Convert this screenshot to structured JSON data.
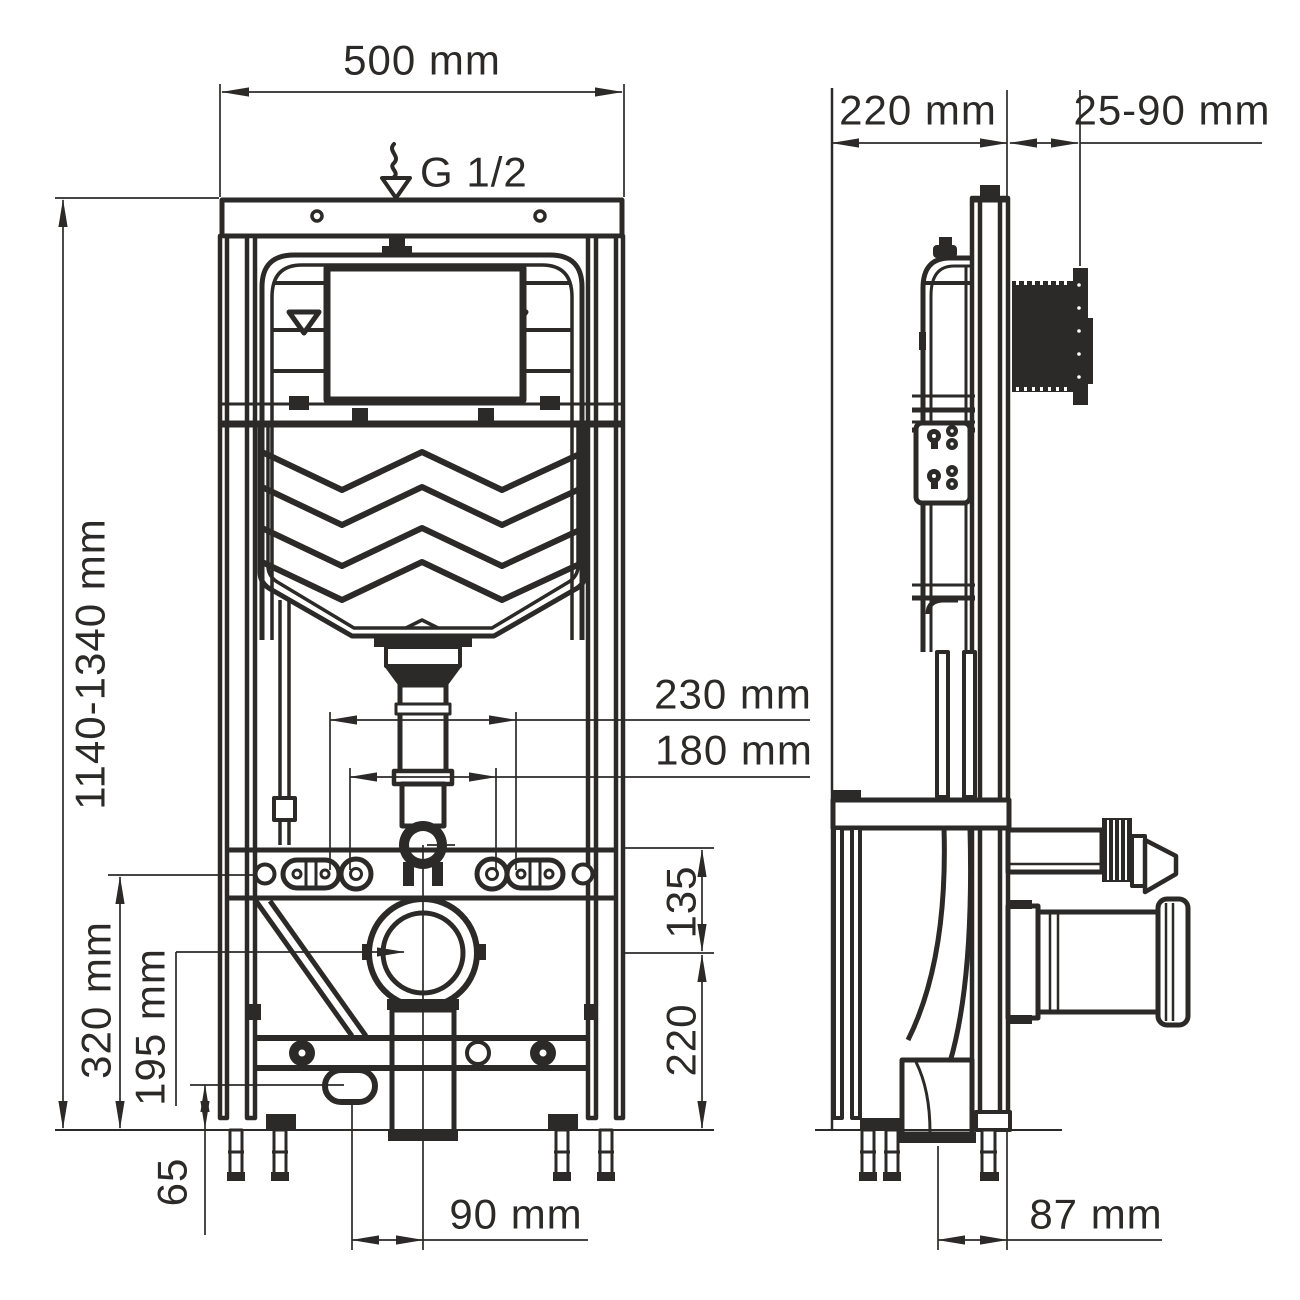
{
  "page": {
    "background": "#ffffff",
    "line_color": "#2b2a29",
    "description_labels": {
      "drawing": "wall-hung toilet installation frame, front and side views"
    }
  },
  "dimensions": {
    "frame_width": "500 mm",
    "water_supply_thread": "G 1/2",
    "frame_depth": "220 mm",
    "panel_depth_range": "25-90 mm",
    "frame_height_range": "1140-1340 mm",
    "fixing_spacing_outer": "230 mm",
    "fixing_spacing_inner": "180 mm",
    "bar_to_drain_axis": "135",
    "drain_axis_height": "220",
    "studs_height": "320 mm",
    "outlet_axis_height": "195 mm",
    "oval_outlet_height": "65",
    "drain_horizontal_offset": "90 mm",
    "side_drain_offset": "87 mm"
  },
  "icons": {
    "water_drop": "water-supply-drop"
  }
}
